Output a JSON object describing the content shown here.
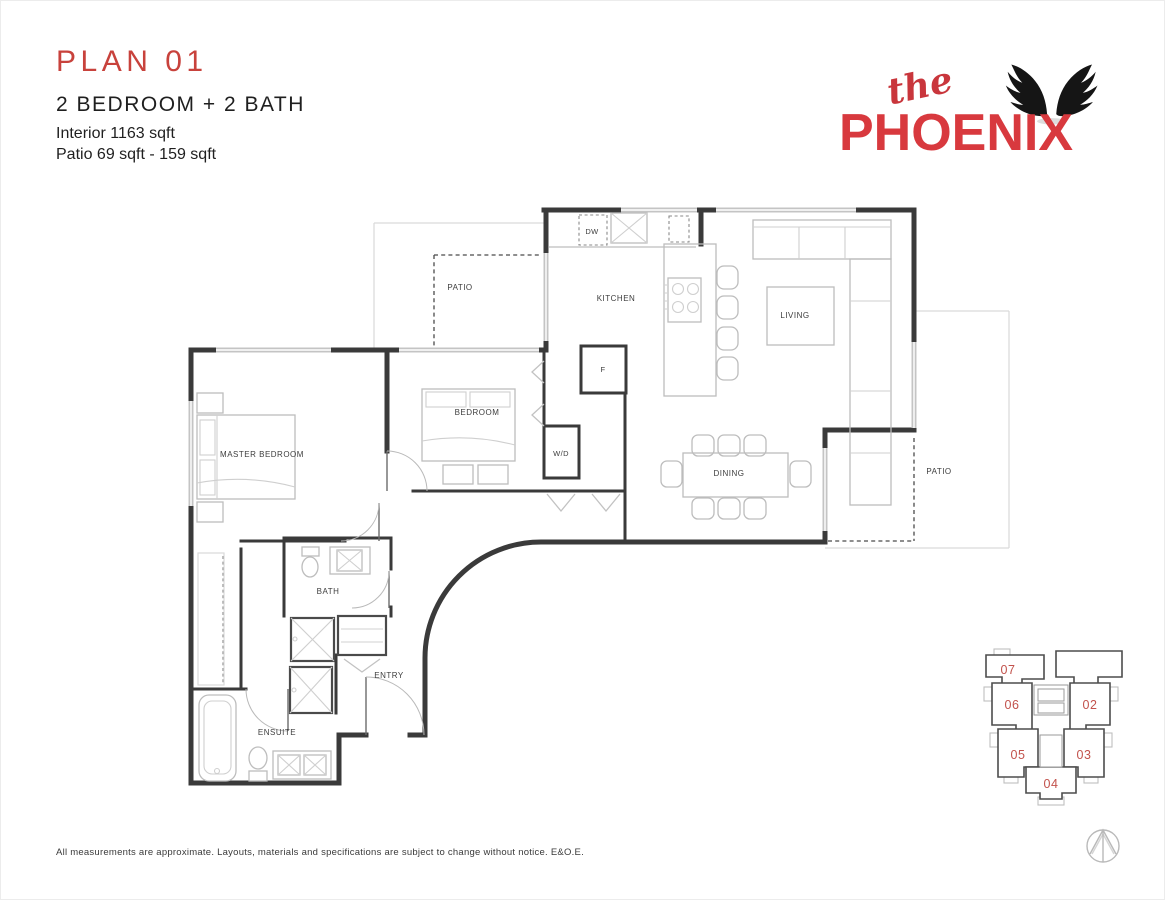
{
  "header": {
    "plan_title": "PLAN 01",
    "subtitle": "2 BEDROOM + 2 BATH",
    "interior_area": "Interior 1163 sqft",
    "patio_area": "Patio 69 sqft - 159 sqft"
  },
  "logo": {
    "prefix": "the",
    "name": "PHOENIX"
  },
  "floorplan": {
    "rooms": {
      "patio_upper": "PATIO",
      "kitchen": "KITCHEN",
      "living": "LIVING",
      "dining": "DINING",
      "bedroom": "BEDROOM",
      "master_bedroom": "MASTER BEDROOM",
      "bath": "BATH",
      "ensuite": "ENSUITE",
      "entry": "ENTRY",
      "patio_right": "PATIO",
      "dishwasher": "DW",
      "fridge": "F",
      "washer_dryer": "W/D"
    }
  },
  "keyplan": {
    "units": {
      "u01": "01",
      "u02": "02",
      "u03": "03",
      "u04": "04",
      "u05": "05",
      "u06": "06",
      "u07": "07"
    }
  },
  "footer": {
    "disclaimer": "All measurements are approximate. Layouts, materials and specifications are subject to change without notice. E&O.E."
  },
  "icons": {
    "logo_mark": "phoenix-wings-icon",
    "orientation": "north-arrow-compass-icon"
  },
  "colors": {
    "accent_red": "#c8423c",
    "logo_red": "#d8393e",
    "wall_gray": "#3a3a3a",
    "furniture_gray": "#bdbdbd",
    "keyplan_number_red": "#c2524c"
  }
}
